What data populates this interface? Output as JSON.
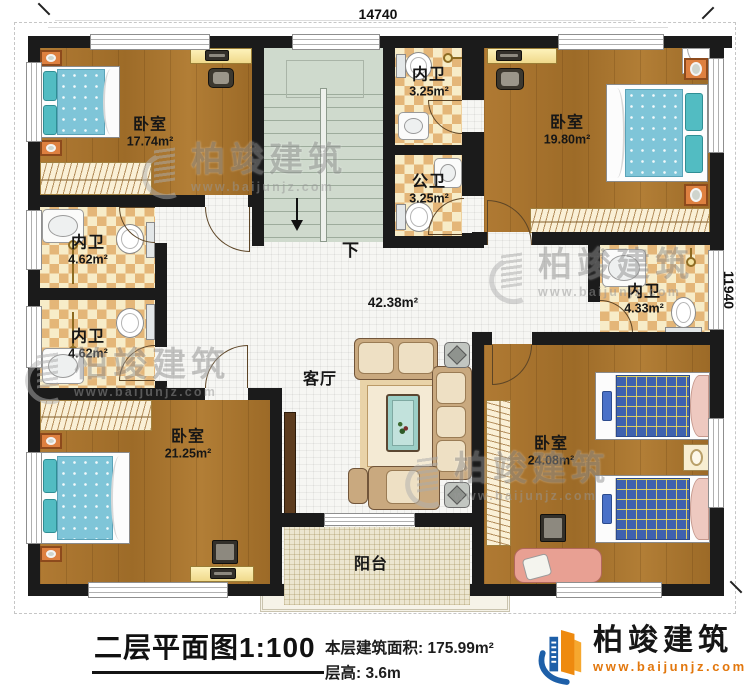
{
  "dimensions": {
    "top": "14740",
    "right": "11940"
  },
  "rooms": [
    {
      "name": "卧室",
      "area": "17.74m²"
    },
    {
      "name": "内卫",
      "area": "3.25m²"
    },
    {
      "name": "公卫",
      "area": "3.25m²"
    },
    {
      "name": "卧室",
      "area": "19.80m²"
    },
    {
      "name": "内卫",
      "area": "4.62m²"
    },
    {
      "name": "内卫",
      "area": "4.62m²"
    },
    {
      "name": "内卫",
      "area": "4.33m²"
    },
    {
      "name": "客厅",
      "area": "42.38m²"
    },
    {
      "name": "卧室",
      "area": "21.25m²"
    },
    {
      "name": "卧室",
      "area": "24.08m²"
    },
    {
      "name": "阳台"
    },
    {
      "direction": "下"
    }
  ],
  "title": "二层平面图1:100",
  "info": {
    "floor_area": "本层建筑面积: 175.99m²",
    "floor_height": "层高: 3.6m"
  },
  "brand": {
    "name": "柏竣建筑",
    "website": "www.baijunjz.com"
  },
  "watermark": {
    "name": "柏竣建筑",
    "website": "www.baijunjz.com"
  },
  "colors": {
    "wall": "#1b1b1b",
    "wood_floor": "#a7722c",
    "tile_dark": "#e4b678",
    "tile_light": "#f7ecc8",
    "stairs": "#cfdacd",
    "living_floor": "#f6f6f3",
    "balcony": "#ece6d0",
    "brand_blue": "#1d5fa8",
    "brand_orange": "#ee8a0f"
  }
}
